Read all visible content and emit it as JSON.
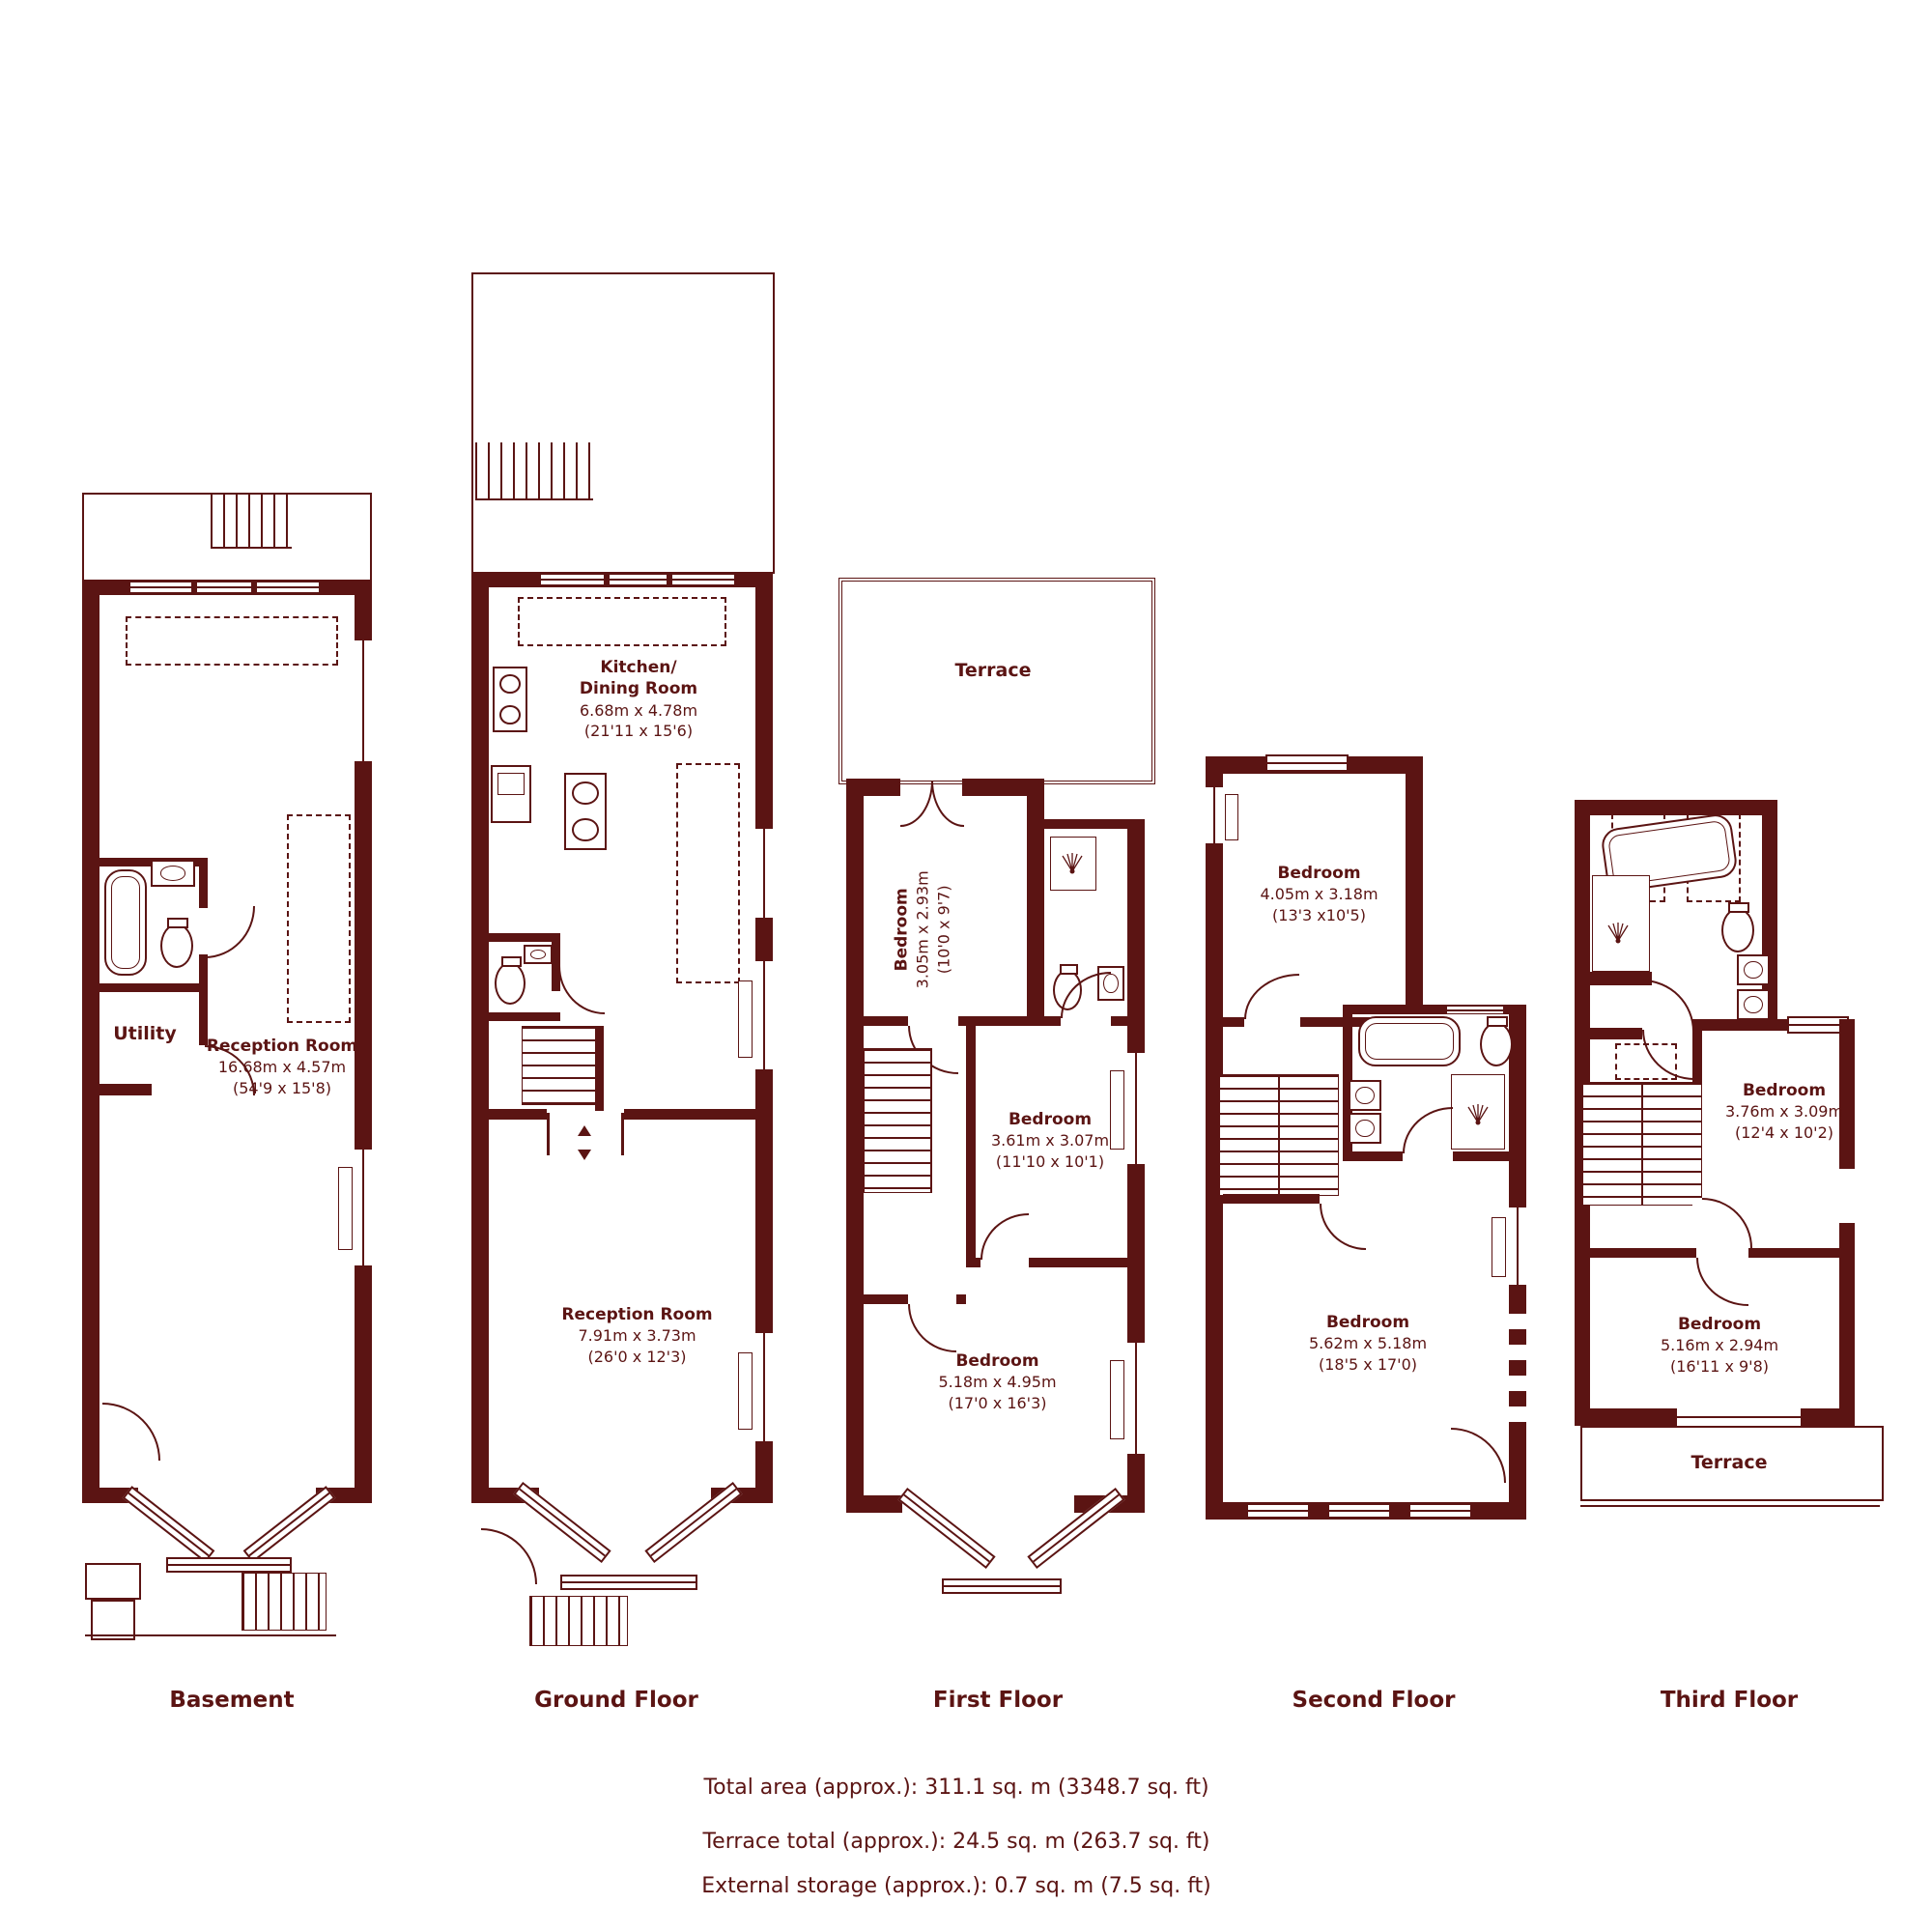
{
  "colors": {
    "wall_and_text": "#5b1413",
    "background": "#ffffff"
  },
  "icons": {
    "bathtub": "css-rounded-rect",
    "toilet": "css-ellipse-with-tank",
    "sink": "css-rect-with-circle",
    "shower": "svg-spray-lines",
    "stairs": "css-stripes",
    "door": "css-quarter-arc",
    "window": "css-double-line",
    "hob": "css-rect-with-burners",
    "oven": "css-rect-with-inner-box"
  },
  "floors": [
    {
      "title": "Basement",
      "rooms": [
        {
          "name": "Utility"
        },
        {
          "name": "Reception Room",
          "dims_m": "16.68m x 4.57m",
          "dims_ft": "(54'9 x 15'8)"
        }
      ]
    },
    {
      "title": "Ground Floor",
      "rooms": [
        {
          "name": "Kitchen/",
          "name_line2": "Dining Room",
          "dims_m": "6.68m x 4.78m",
          "dims_ft": "(21'11 x 15'6)"
        },
        {
          "name": "Reception Room",
          "dims_m": "7.91m x 3.73m",
          "dims_ft": "(26'0 x 12'3)"
        }
      ]
    },
    {
      "title": "First Floor",
      "rooms": [
        {
          "name": "Terrace"
        },
        {
          "name": "Bedroom",
          "dims_m": "3.05m x 2.93m",
          "dims_ft": "(10'0 x 9'7)"
        },
        {
          "name": "Bedroom",
          "dims_m": "3.61m x 3.07m",
          "dims_ft": "(11'10 x 10'1)"
        },
        {
          "name": "Bedroom",
          "dims_m": "5.18m x 4.95m",
          "dims_ft": "(17'0 x 16'3)"
        }
      ]
    },
    {
      "title": "Second Floor",
      "rooms": [
        {
          "name": "Bedroom",
          "dims_m": "4.05m x 3.18m",
          "dims_ft": "(13'3 x10'5)"
        },
        {
          "name": "Bedroom",
          "dims_m": "5.62m x 5.18m",
          "dims_ft": "(18'5 x 17'0)"
        }
      ]
    },
    {
      "title": "Third Floor",
      "rooms": [
        {
          "name": "Bedroom",
          "dims_m": "3.76m x 3.09m",
          "dims_ft": "(12'4 x 10'2)"
        },
        {
          "name": "Bedroom",
          "dims_m": "5.16m x 2.94m",
          "dims_ft": "(16'11 x 9'8)"
        },
        {
          "name": "Terrace"
        }
      ]
    }
  ],
  "summary": [
    "Total area (approx.): 311.1 sq. m (3348.7 sq. ft)",
    "Terrace total (approx.): 24.5 sq. m (263.7 sq. ft)",
    "External storage (approx.): 0.7 sq. m (7.5 sq. ft)"
  ]
}
